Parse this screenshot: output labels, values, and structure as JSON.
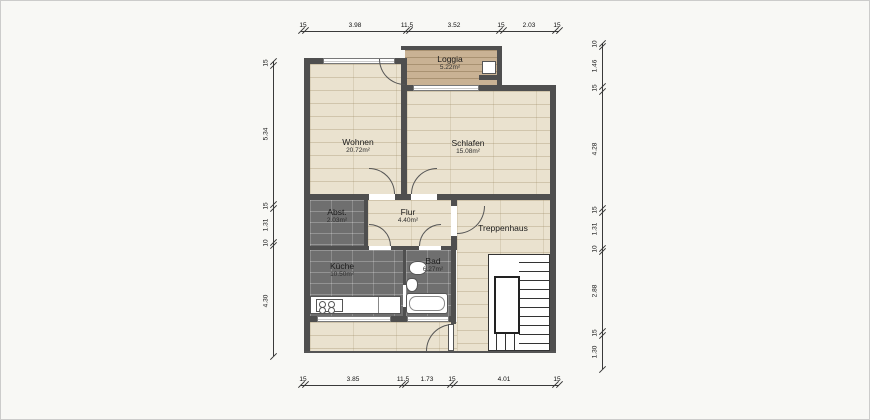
{
  "rooms": {
    "loggia": {
      "name": "Loggia",
      "area": "5.22m²"
    },
    "wohnen": {
      "name": "Wohnen",
      "area": "20.72m²"
    },
    "schlafen": {
      "name": "Schlafen",
      "area": "15.08m²"
    },
    "abstell": {
      "name": "Abst.",
      "area": "2.03m²"
    },
    "flur": {
      "name": "Flur",
      "area": "4.40m²"
    },
    "treppenhaus": {
      "name": "Treppenhaus"
    },
    "kueche": {
      "name": "Küche",
      "area": "10.50m²"
    },
    "bad": {
      "name": "Bad",
      "area": "6.27m²"
    }
  },
  "dimensions": {
    "top": [
      "15",
      "3.98",
      "11.5",
      "3.52",
      "15",
      "2.03",
      "15"
    ],
    "bottom": [
      "15",
      "3.85",
      "11.5",
      "1.73",
      "15",
      "4.01",
      "15"
    ],
    "left": [
      "15",
      "5.34",
      "15",
      "1.31",
      "10",
      "4.30"
    ],
    "right": [
      "10",
      "1.46",
      "15",
      "4.28",
      "15",
      "1.31",
      "10",
      "2.88",
      "15",
      "1.30"
    ]
  },
  "colors": {
    "wall": "#4f4f4f",
    "wood_floor": "#eae2cf",
    "tile_floor": "#6f6f6f",
    "loggia_floor": "#c9b294",
    "dimension_line": "#3a3a3a",
    "background": "#f8f8f5"
  }
}
